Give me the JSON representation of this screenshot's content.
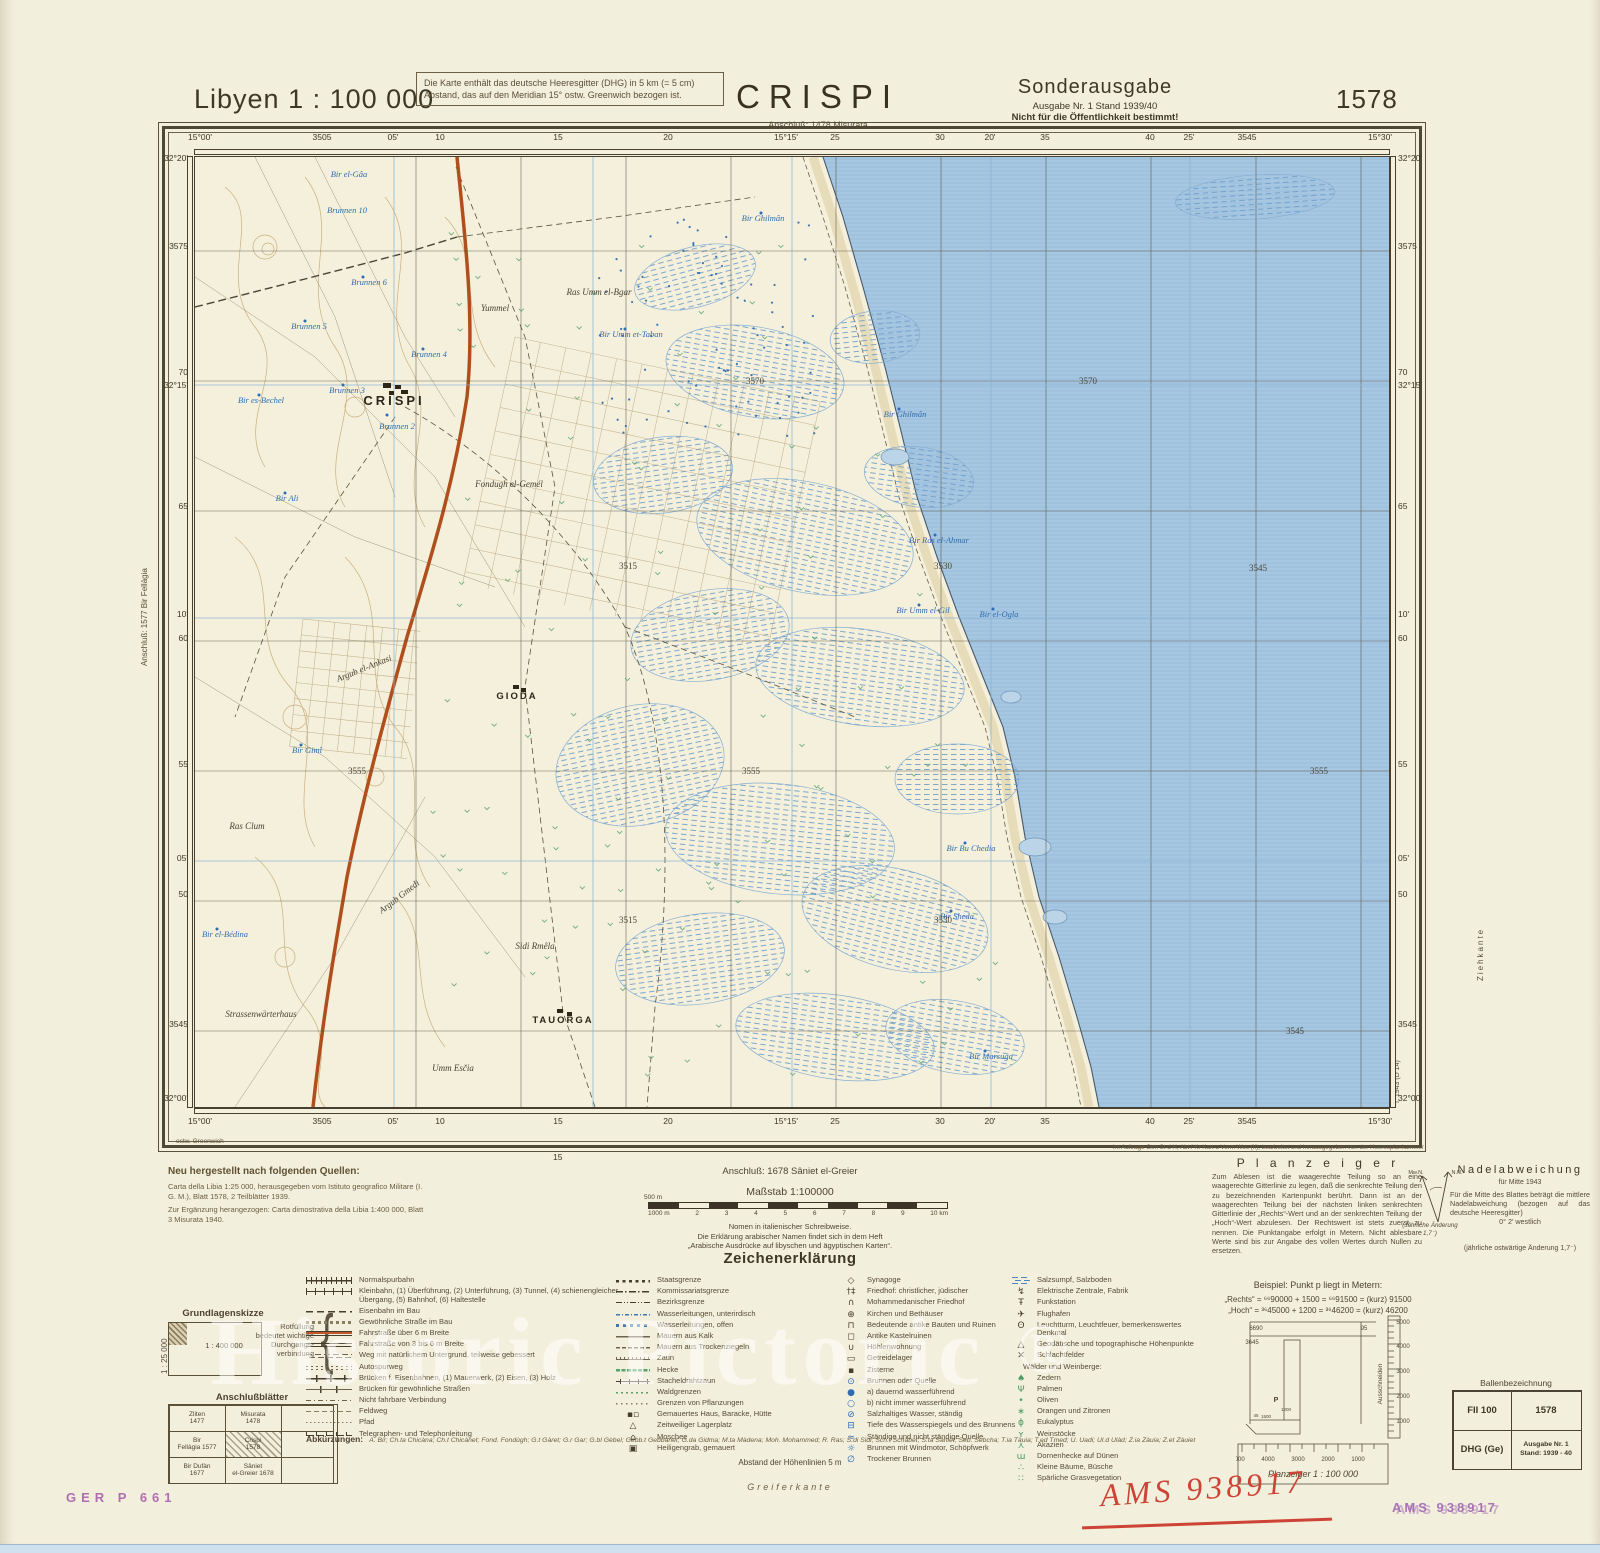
{
  "header": {
    "series_title": "Libyen 1 : 100 000",
    "note_box": "Die Karte enthält das deutsche Heeresgitter (DHG) in 5 km (= 5 cm) Abstand, das auf den Meridian 15° ostw. Greenwich bezogen ist.",
    "sheet_name": "CRISPI",
    "sheet_sub": "Anschluß: 1478 Misurata",
    "edition_title": "Sonderausgabe",
    "edition_line1": "Ausgabe Nr. 1   Stand 1939/40",
    "edition_line2": "Nicht für die Öffentlichkeit bestimmt!",
    "sheet_number": "1578"
  },
  "margins": {
    "left_vertical": "Anschluß: 1577 Bir Fellàgia",
    "ziehkante": "Ziehkante",
    "print_code": "I. 1943 (D 14)",
    "ostw": "ostw. Greenwich",
    "below_15": "15"
  },
  "frame": {
    "top": [
      {
        "t": "15°00'",
        "x": 200
      },
      {
        "t": "3505",
        "x": 322
      },
      {
        "t": "05'",
        "x": 393
      },
      {
        "t": "10",
        "x": 440
      },
      {
        "t": "15",
        "x": 558
      },
      {
        "t": "20",
        "x": 668
      },
      {
        "t": "15°15'",
        "x": 786
      },
      {
        "t": "25",
        "x": 835
      },
      {
        "t": "30",
        "x": 940
      },
      {
        "t": "20'",
        "x": 990
      },
      {
        "t": "35",
        "x": 1045
      },
      {
        "t": "40",
        "x": 1150
      },
      {
        "t": "25'",
        "x": 1189
      },
      {
        "t": "3545",
        "x": 1247
      },
      {
        "t": "15°30'",
        "x": 1380
      }
    ],
    "left": [
      {
        "t": "32°20'",
        "y": 158
      },
      {
        "t": "3575",
        "y": 246
      },
      {
        "t": "70",
        "y": 372
      },
      {
        "t": "32°15'",
        "y": 385
      },
      {
        "t": "65",
        "y": 506
      },
      {
        "t": "10'",
        "y": 614
      },
      {
        "t": "60",
        "y": 638
      },
      {
        "t": "55",
        "y": 764
      },
      {
        "t": "05'",
        "y": 858
      },
      {
        "t": "50",
        "y": 894
      },
      {
        "t": "3545",
        "y": 1024
      },
      {
        "t": "32°00'",
        "y": 1098
      }
    ]
  },
  "map": {
    "labels": [
      {
        "t": "CRISPI",
        "x": 199,
        "y": 248,
        "c": "mj"
      },
      {
        "t": "GIODA",
        "x": 322,
        "y": 542,
        "c": "tn"
      },
      {
        "t": "TAUORGA",
        "x": 368,
        "y": 866,
        "c": "tn"
      },
      {
        "t": "Yummel",
        "x": 300,
        "y": 154,
        "c": "ge"
      },
      {
        "t": "Ras Umm el-Bgar",
        "x": 404,
        "y": 138,
        "c": "ge"
      },
      {
        "t": "Sidi Rmêla",
        "x": 340,
        "y": 792,
        "c": "ge"
      },
      {
        "t": "Umm Esčia",
        "x": 258,
        "y": 914,
        "c": "ge"
      },
      {
        "t": "Strassenwärterhaus",
        "x": 66,
        "y": 860,
        "c": "ge"
      },
      {
        "t": "Argub el-Ankasi",
        "x": 170,
        "y": 514,
        "c": "ge",
        "r": -22
      },
      {
        "t": "Argub Gmedi",
        "x": 206,
        "y": 742,
        "c": "ge",
        "r": -38
      },
      {
        "t": "Fondugh el-Gemél",
        "x": 314,
        "y": 330,
        "c": "ge"
      },
      {
        "t": "Ras Clum",
        "x": 52,
        "y": 672,
        "c": "ge"
      },
      {
        "t": "Bir el-Gâa",
        "x": 154,
        "y": 20,
        "c": "wt"
      },
      {
        "t": "Brunnen 10",
        "x": 152,
        "y": 56,
        "c": "wt"
      },
      {
        "t": "Brunnen 6",
        "x": 174,
        "y": 128,
        "c": "wt"
      },
      {
        "t": "Brunnen 5",
        "x": 114,
        "y": 172,
        "c": "wt"
      },
      {
        "t": "Brunnen 4",
        "x": 234,
        "y": 200,
        "c": "wt"
      },
      {
        "t": "Brunnen 3",
        "x": 152,
        "y": 236,
        "c": "wt"
      },
      {
        "t": "Brunnen 2",
        "x": 202,
        "y": 272,
        "c": "wt"
      },
      {
        "t": "Bir es-Bechel",
        "x": 66,
        "y": 246,
        "c": "wt"
      },
      {
        "t": "Bir Ali",
        "x": 92,
        "y": 344,
        "c": "wt"
      },
      {
        "t": "Bir Umm et-Taban",
        "x": 436,
        "y": 180,
        "c": "wt"
      },
      {
        "t": "Bir Ghilmân",
        "x": 568,
        "y": 64,
        "c": "wt"
      },
      {
        "t": "Bir Ghilmân",
        "x": 710,
        "y": 260,
        "c": "wt"
      },
      {
        "t": "Bir Ras el-Ahmar",
        "x": 744,
        "y": 386,
        "c": "wt"
      },
      {
        "t": "Bir Umm el-Gil",
        "x": 728,
        "y": 456,
        "c": "wt"
      },
      {
        "t": "Bir el-Ogla",
        "x": 804,
        "y": 460,
        "c": "wt"
      },
      {
        "t": "Bir Bu Chedia",
        "x": 776,
        "y": 694,
        "c": "wt"
      },
      {
        "t": "Bir Sheda",
        "x": 762,
        "y": 762,
        "c": "wt"
      },
      {
        "t": "Bir Marsuga",
        "x": 796,
        "y": 902,
        "c": "wt"
      },
      {
        "t": "Bir Gimî",
        "x": 112,
        "y": 596,
        "c": "wt"
      },
      {
        "t": "Bir el-Bédina",
        "x": 30,
        "y": 780,
        "c": "wt"
      },
      {
        "t": "3570",
        "x": 560,
        "y": 227,
        "c": "gd"
      },
      {
        "t": "3570",
        "x": 893,
        "y": 227,
        "c": "gd"
      },
      {
        "t": "3515",
        "x": 433,
        "y": 412,
        "c": "gd"
      },
      {
        "t": "3530",
        "x": 748,
        "y": 412,
        "c": "gd"
      },
      {
        "t": "3545",
        "x": 1063,
        "y": 414,
        "c": "gd"
      },
      {
        "t": "3555",
        "x": 162,
        "y": 617,
        "c": "gd"
      },
      {
        "t": "3555",
        "x": 556,
        "y": 617,
        "c": "gd"
      },
      {
        "t": "3555",
        "x": 1124,
        "y": 617,
        "c": "gd"
      },
      {
        "t": "3515",
        "x": 433,
        "y": 766,
        "c": "gd"
      },
      {
        "t": "3530",
        "x": 748,
        "y": 766,
        "c": "gd"
      },
      {
        "t": "3545",
        "x": 1100,
        "y": 877,
        "c": "gd"
      }
    ]
  },
  "footer": {
    "sources": {
      "heading": "Neu hergestellt nach folgenden Quellen:",
      "lines": [
        "Carta della Libia 1:25 000, herausgegeben vom Istituto geografico Militare (I. G. M.), Blatt 1578, 2 Teilblätter 1939.",
        "Zur Ergänzung herangezogen: Carta dimostrativa della Libia 1:400 000, Blatt 3 Misurata 1940."
      ]
    },
    "grundlagen": {
      "title": "Grundlagenskizze",
      "main": "1 : 400 000",
      "side": "1 : 25 000"
    },
    "rot_note": "Rotfüllung bedeutet wichtige Durchgangs­verbindung",
    "brace": "{",
    "anschluss": {
      "title": "Anschlußblätter",
      "cells": [
        {
          "a": "Zliten",
          "b": "1477"
        },
        {
          "a": "Misurata",
          "b": "1478"
        },
        {
          "a": "",
          "b": ""
        },
        {
          "a": "Bir",
          "b": "Fellàgia 1577"
        },
        {
          "a": "Crispi",
          "b": "1578",
          "sym": "hatch"
        },
        {
          "a": "",
          "b": ""
        },
        {
          "a": "Bir Dufàn",
          "b": "1677"
        },
        {
          "a": "Sâniet",
          "b": "el-Greier 1678"
        },
        {
          "a": "",
          "b": ""
        }
      ]
    },
    "anschluss_line": "Anschluß: 1678 Sâniet el-Greier",
    "massstab": "Maßstab 1:100000",
    "scale": {
      "pre": "500 m",
      "nums": [
        "1000 m",
        "2",
        "3",
        "4",
        "5",
        "6",
        "7",
        "8",
        "9",
        "10 km"
      ]
    },
    "nomen": [
      "Nomen in italienischer Schreibweise.",
      "Die Erklärung arabischer Namen findet sich in dem Heft",
      "„Arabische Ausdrücke auf libyschen und ägyptischen Karten“."
    ],
    "ze_title": "Zeichenerklärung",
    "legend_col1": [
      {
        "sym": "rail",
        "label": "Normalspurbahn"
      },
      {
        "sym": "rail2",
        "label": "Kleinbahn, (1) Überführung, (2) Unterführung, (3) Tunnel, (4) schienengleicher Übergang, (5) Bahnhof, (6) Haltestelle"
      },
      {
        "sym": "dash",
        "label": "Eisenbahn im Bau"
      },
      {
        "sym": "sqdash",
        "label": "Gewöhnliche Straße im Bau"
      },
      {
        "sym": "road2",
        "label": "Fahrstraße über 6 m Breite"
      },
      {
        "sym": "road1",
        "label": "Fahrstraße von 3 bis 6 m Breite"
      },
      {
        "sym": "trackn",
        "label": "Weg mit natürlichem Untergrund, teilweise gebessert"
      },
      {
        "sym": "auto",
        "label": "Autospurweg"
      },
      {
        "sym": "bridge",
        "label": "Brücken f. Eisenbahnen, (1) Mauerwerk, (2) Eisen, (3) Holz"
      },
      {
        "sym": "bridge2",
        "label": "Brücken für gewöhnliche Straßen"
      },
      {
        "sym": "nf",
        "label": "Nicht fahrbare Verbindung"
      },
      {
        "sym": "feld",
        "label": "Feldweg"
      },
      {
        "sym": "pfad",
        "label": "Pfad"
      },
      {
        "sym": "tele",
        "label": "Telegraphen- und Telephonleitung"
      }
    ],
    "legend_col2": [
      {
        "sym": "b1",
        "label": "Staatsgrenze"
      },
      {
        "sym": "b2",
        "label": "Kommissariatsgrenze"
      },
      {
        "sym": "b3",
        "label": "Bezirksgrenze"
      },
      {
        "sym": "wl1",
        "label": "Wasserleitungen, unterirdisch"
      },
      {
        "sym": "wl2",
        "label": "Wasserleitungen, offen"
      },
      {
        "sym": "mk",
        "label": "Mauern aus Kalk"
      },
      {
        "sym": "mt",
        "label": "Mauern aus Trockenziegeln"
      },
      {
        "sym": "zn",
        "label": "Zaun"
      },
      {
        "sym": "hk",
        "label": "Hecke"
      },
      {
        "sym": "sd",
        "label": "Stacheldrahtzaun"
      },
      {
        "sym": "wg",
        "label": "Waldgrenzen"
      },
      {
        "sym": "gp",
        "label": "Grenzen von Pflanzungen"
      },
      {
        "sym": "g",
        "glyph": "▪▫",
        "label": "Gemauertes Haus, Baracke, Hütte"
      },
      {
        "sym": "g",
        "glyph": "△",
        "label": "Zeitweiliger Lagerplatz"
      },
      {
        "sym": "g",
        "glyph": "⌂",
        "label": "Moschee"
      },
      {
        "sym": "g",
        "glyph": "▣",
        "label": "Heiligengrab, gemauert"
      }
    ],
    "legend_col3": [
      {
        "sym": "g",
        "glyph": "◇",
        "label": "Synagoge"
      },
      {
        "sym": "g",
        "glyph": "†‡",
        "label": "Friedhof: christlicher, jüdischer"
      },
      {
        "sym": "g",
        "glyph": "∩",
        "label": "Mohammedanischer Friedhof"
      },
      {
        "sym": "g",
        "glyph": "⊕",
        "label": "Kirchen und Bethäuser"
      },
      {
        "sym": "g",
        "glyph": "⊓",
        "label": "Bedeutende antike Bauten und Ruinen"
      },
      {
        "sym": "g",
        "glyph": "◻",
        "label": "Antike Kastelruinen"
      },
      {
        "sym": "g",
        "glyph": "∪",
        "label": "Höhlenwohnung"
      },
      {
        "sym": "g",
        "glyph": "▭",
        "label": "Getreidelager"
      },
      {
        "sym": "g",
        "glyph": "▪",
        "label": "Zisterne"
      },
      {
        "sym": "gblu",
        "glyph": "⊙",
        "label": "Brunnen oder Quelle"
      },
      {
        "sym": "gblu",
        "glyph": "●",
        "label": "  a) dauernd wasserführend"
      },
      {
        "sym": "gblu",
        "glyph": "○",
        "label": "  b) nicht immer wasserführend"
      },
      {
        "sym": "gblu",
        "glyph": "⊘",
        "label": "Salzhaltiges Wasser, ständig"
      },
      {
        "sym": "gblu",
        "glyph": "⊟",
        "label": "Tiefe des Wasserspiegels und des Brunnens"
      },
      {
        "sym": "gblu",
        "glyph": "≈",
        "label": "Ständige und nicht ständige Quelle"
      },
      {
        "sym": "gblu",
        "glyph": "☼",
        "label": "Brunnen mit Windmotor, Schöpfwerk"
      },
      {
        "sym": "gblu",
        "glyph": "∅",
        "label": "Trockener Brunnen"
      }
    ],
    "legend_col4": [
      {
        "sym": "marsh",
        "label": "Salzsumpf, Salzboden"
      },
      {
        "sym": "g",
        "glyph": "↯",
        "label": "Elektrische Zentrale, Fabrik"
      },
      {
        "sym": "g",
        "glyph": "Ŧ",
        "label": "Funkstation"
      },
      {
        "sym": "g",
        "glyph": "✈",
        "label": "Flughafen"
      },
      {
        "sym": "g",
        "glyph": "ʘ",
        "label": "Leuchtturm, Leuchtfeuer, bemerkenswertes Denkmal"
      },
      {
        "sym": "g",
        "glyph": "△",
        "label": "Geodätische und topographische Höhenpunkte"
      },
      {
        "sym": "g",
        "glyph": "✕",
        "label": "Schlachtfelder"
      },
      {
        "sym": "hd",
        "glyph": "",
        "label": "Wälder und Weinberge:"
      },
      {
        "sym": "ggrn",
        "glyph": "♠",
        "label": "Zedern"
      },
      {
        "sym": "ggrn",
        "glyph": "Ψ",
        "label": "Palmen"
      },
      {
        "sym": "ggrn",
        "glyph": "•",
        "label": "Oliven"
      },
      {
        "sym": "ggrn",
        "glyph": "∗",
        "label": "Orangen und Zitronen"
      },
      {
        "sym": "ggrn",
        "glyph": "ɸ",
        "label": "Eukalyptus"
      },
      {
        "sym": "ggrn",
        "glyph": "ʏ",
        "label": "Weinstöcke"
      },
      {
        "sym": "ggrn",
        "glyph": "⋏",
        "label": "Akazien"
      },
      {
        "sym": "ggrn",
        "glyph": "ɯ",
        "label": "Dornenhecke auf Dünen"
      },
      {
        "sym": "ggrn",
        "glyph": "∴",
        "label": "Kleine Bäume, Büsche"
      },
      {
        "sym": "ggrn",
        "glyph": "∷",
        "label": "Spärliche Grasvegetation"
      }
    ],
    "abk_label": "Abkürzungen:",
    "abk_text": "A. Bir;  Ch.ta Chicàna;  Ch.t Chicànet;  Fond. Fondùgh;  G.t Gàret;  G.r Gar;  G.bl Gèbel;  Gebb.t Gebbànet;  G.da Gidma;  M.ta Màdena;  Moh. Mohammed;  R. Ras;  S.di Sidi;  Sch.t Schàbet;  S.ta Sàniet;  Seb. Sebcha;  T.ia Tàuia;  T.ed Tmed;  U. Uadi;  Ul.d Ulàd;  Z.ia Zàuia;  Z.et Zàuiet",
    "abst_line": "Abstand der Höhenlinien 5 m",
    "greifer": "Greiferkante",
    "auftrag": "Im Auftrage Gen St d H, Abt f Kr Kart u Verm Wes (II), bearbeitet und herausgegeben von der Heeresplankammer",
    "planzeiger": {
      "title": "P l a n z e i g e r",
      "body": "Zum Ablesen ist die waagerechte Teilung so an eine waagerechte Gitterlinie zu legen, daß die senkrechte Teilung den zu bezeichnenden Kartenpunkt berührt. Dann ist an der waagerechten Teilung bei der nächsten linken senkrechten Gitterlinie der „Rechts“-Wert und an der senkrechten Teilung der „Hoch“-Wert abzulesen. Der Rechtswert ist stets zuerst zu nennen. Die Punktangabe erfolgt in Metern. Nicht ablesbare Werte sind bis zur Angabe des vollen Wertes durch Nullen zu ersetzen.",
      "beispiel": "Beispiel: Punkt p liegt in Metern:",
      "rechts": "„Rechts“ = ⁶⁶90000 + 1500 = ⁶⁶91500 = (kurz) 91500",
      "hoch": "„Hoch“ = ³⁶45000 + 1200 = ³⁶46200 = (kurz) 46200",
      "diagram": {
        "tl": "6690",
        "tr": "95",
        "l": "3645",
        "p": "P",
        "v": "1200",
        "h": "1500",
        "corner": "45",
        "cut": "Ausschneiden",
        "label": "Planzeiger 1 : 100 000",
        "rnums": [
          "5000",
          "4000",
          "3000",
          "2000",
          "1000"
        ],
        "bnums": [
          "5000",
          "4000",
          "3000",
          "2000",
          "1000"
        ]
      }
    },
    "nadel": {
      "title": "Nadelabweichung",
      "sub": "für Mitte 1943",
      "body": "Für die Mitte des Blattes beträgt die mittlere Nadelabweichung (bezogen auf das deutsche Heeresgitter)",
      "value": "0° 2′ westlich",
      "last": "(jährliche ostwärtige Änderung 1,7⁻)"
    },
    "compass": {
      "left": "Mw.N.",
      "right": "N.N.",
      "note": "(Jährliche Änderung 1,7⁻)"
    },
    "ballen": {
      "title": "Ballenbezeichnung",
      "c1": "FII 100",
      "c2": "1578",
      "c3": "DHG (Ge)",
      "c4a": "Ausgabe Nr. 1",
      "c4b": "Stand: 1939 - 40"
    }
  },
  "stamps": {
    "ger": "GER P 661",
    "ams_hand": "AMS 938917",
    "ams_purple": "AMS  938917"
  },
  "watermark": {
    "text": "Historic Pictoric",
    "reg": "®"
  }
}
